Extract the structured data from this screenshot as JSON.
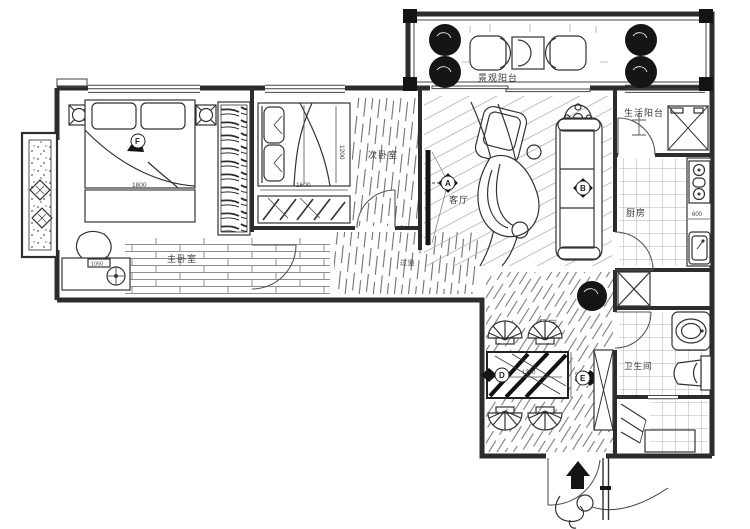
{
  "plan": {
    "rooms": {
      "scenic_balcony": {
        "label": "景观阳台"
      },
      "life_balcony": {
        "label": "生活阳台"
      },
      "kitchen": {
        "label": "厨房"
      },
      "living": {
        "label": "客厅"
      },
      "second_bedroom": {
        "label": "次卧室"
      },
      "master_bedroom": {
        "label": "主卧室"
      },
      "hallway": {
        "label": "过道"
      },
      "dining": {
        "label": "餐厅"
      },
      "bathroom": {
        "label": "卫生间"
      }
    },
    "markers": {
      "master_bed": "F",
      "living": "A",
      "sofa": "B",
      "dining_table": "D",
      "dining_cabinet": "E"
    },
    "dims": {
      "master_bed": "1800",
      "second_bed_len": "1600",
      "second_bed_wid": "1200",
      "desk": "1050",
      "kitchen_counter": "600",
      "table_len": "1300",
      "table_wid": "800"
    },
    "colors": {
      "ink": "#2c2c2c",
      "hatch": "#9a9a9a",
      "dark_fill": "#141414"
    }
  }
}
